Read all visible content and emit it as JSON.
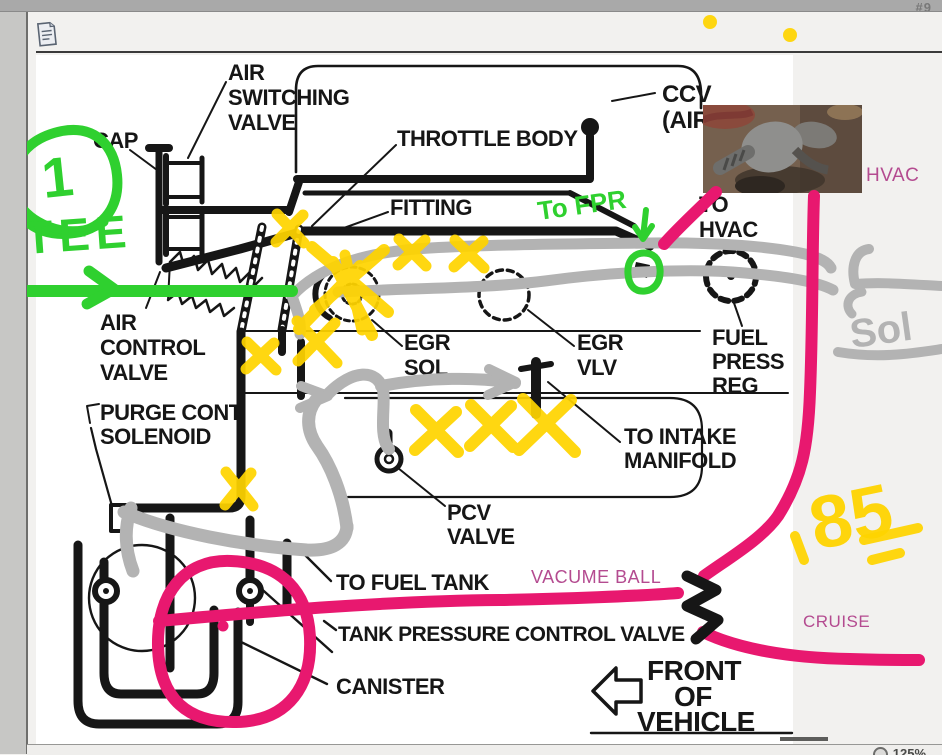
{
  "chrome": {
    "top_right_text": "#9",
    "zoom_level": "125%"
  },
  "diagram": {
    "labels": {
      "cap": "CAP",
      "air_switching_valve": [
        "AIR",
        "SWITCHING",
        "VALVE"
      ],
      "throttle_body": "THROTTLE BODY",
      "ccv": [
        "CCV",
        "(AIR"
      ],
      "fitting": "FITTING",
      "to_hvac": [
        "TO",
        "HVAC"
      ],
      "air_control_valve": [
        "AIR",
        "CONTROL",
        "VALVE"
      ],
      "egr_sol": [
        "EGR",
        "SOL"
      ],
      "egr_vlv": [
        "EGR",
        "VLV"
      ],
      "fuel_press_reg": [
        "FUEL",
        "PRESS",
        "REG"
      ],
      "purge_cont_solenoid": [
        "PURGE CONT",
        "SOLENOID"
      ],
      "to_intake_manifold": [
        "TO INTAKE",
        "MANIFOLD"
      ],
      "pcv_valve": [
        "PCV",
        "VALVE"
      ],
      "to_fuel_tank": "TO FUEL TANK",
      "tank_pressure_control_valve": "TANK PRESSURE CONTROL VALVE",
      "canister": "CANISTER",
      "front_of_vehicle": [
        "FRONT",
        "OF",
        "VEHICLE"
      ]
    }
  },
  "annotations": {
    "green": {
      "circled_number": "1",
      "tee_label": "TEE",
      "to_fpr": "To FPR"
    },
    "yellow": {
      "year": "85"
    },
    "gray": {
      "sol": "Sol"
    },
    "pink": {
      "hvac": "HVAC",
      "vacume_ball": "VACUME BALL",
      "cruise": "CRUISE"
    }
  },
  "colors": {
    "marker_green": "#2fd02f",
    "marker_yellow": "#ffd400",
    "marker_gray": "#b3b3b3",
    "marker_pink": "#e8186f",
    "pink_caption": "#b44b90",
    "ink": "#161616"
  }
}
